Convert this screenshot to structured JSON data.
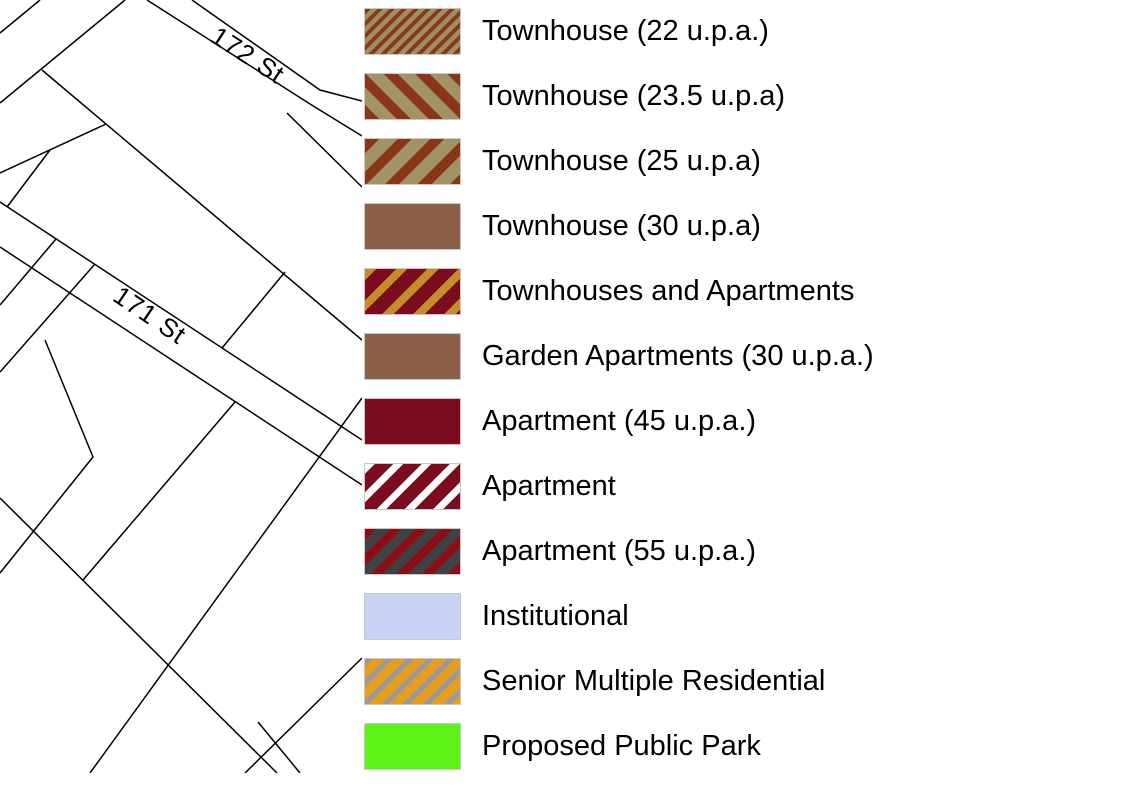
{
  "map": {
    "street_labels": [
      {
        "label": "172 St"
      },
      {
        "label": "171 St"
      }
    ]
  },
  "legend": {
    "items": [
      {
        "label": "Townhouse (22 u.p.a.)",
        "swatch": {
          "pattern": "stripes",
          "background": "#9e8f64",
          "stripe_color": "#8a3817",
          "direction": "/",
          "stripe_width": 4,
          "stripe_gap": 4.5
        }
      },
      {
        "label": "Townhouse (23.5 u.p.a)",
        "swatch": {
          "pattern": "stripes",
          "background": "#a29267",
          "stripe_color": "#8a3418",
          "direction": "\\",
          "stripe_width": 10,
          "stripe_gap": 12.5
        }
      },
      {
        "label": "Townhouse (25 u.p.a)",
        "swatch": {
          "pattern": "stripes",
          "background": "#a29267",
          "stripe_color": "#8a3418",
          "direction": "/",
          "stripe_width": 10,
          "stripe_gap": 13
        }
      },
      {
        "label": "Townhouse (30 u.p.a)",
        "swatch": {
          "pattern": "solid",
          "background": "#8c5f47"
        }
      },
      {
        "label": "Townhouses and Apartments",
        "swatch": {
          "pattern": "stripes",
          "background": "#7b0c1e",
          "stripe_color": "#c28e2c",
          "direction": "/",
          "stripe_width": 8,
          "stripe_gap": 14
        }
      },
      {
        "label": "Garden Apartments (30 u.p.a.)",
        "swatch": {
          "pattern": "solid",
          "background": "#8c5f47"
        }
      },
      {
        "label": "Apartment (45 u.p.a.)",
        "swatch": {
          "pattern": "solid",
          "background": "#7b0c1e"
        }
      },
      {
        "label": "Apartment",
        "swatch": {
          "pattern": "stripes",
          "background": "#7b0c1e",
          "stripe_color": "#ffffff",
          "direction": "/",
          "stripe_width": 7,
          "stripe_gap": 13
        }
      },
      {
        "label": "Apartment (55 u.p.a.)",
        "swatch": {
          "pattern": "stripes",
          "background": "#404045",
          "stripe_color": "#8c0e12",
          "direction": "/",
          "stripe_width": 8,
          "stripe_gap": 10
        }
      },
      {
        "label": "Institutional",
        "swatch": {
          "pattern": "solid",
          "background": "#cad2f6"
        }
      },
      {
        "label": "Senior Multiple Residential",
        "swatch": {
          "pattern": "stripes",
          "background": "#e89d1e",
          "stripe_color": "#9a9a9a",
          "direction": "/",
          "stripe_width": 5.5,
          "stripe_gap": 9
        }
      },
      {
        "label": "Proposed Public Park",
        "swatch": {
          "pattern": "solid",
          "background": "#5df314"
        }
      }
    ]
  }
}
